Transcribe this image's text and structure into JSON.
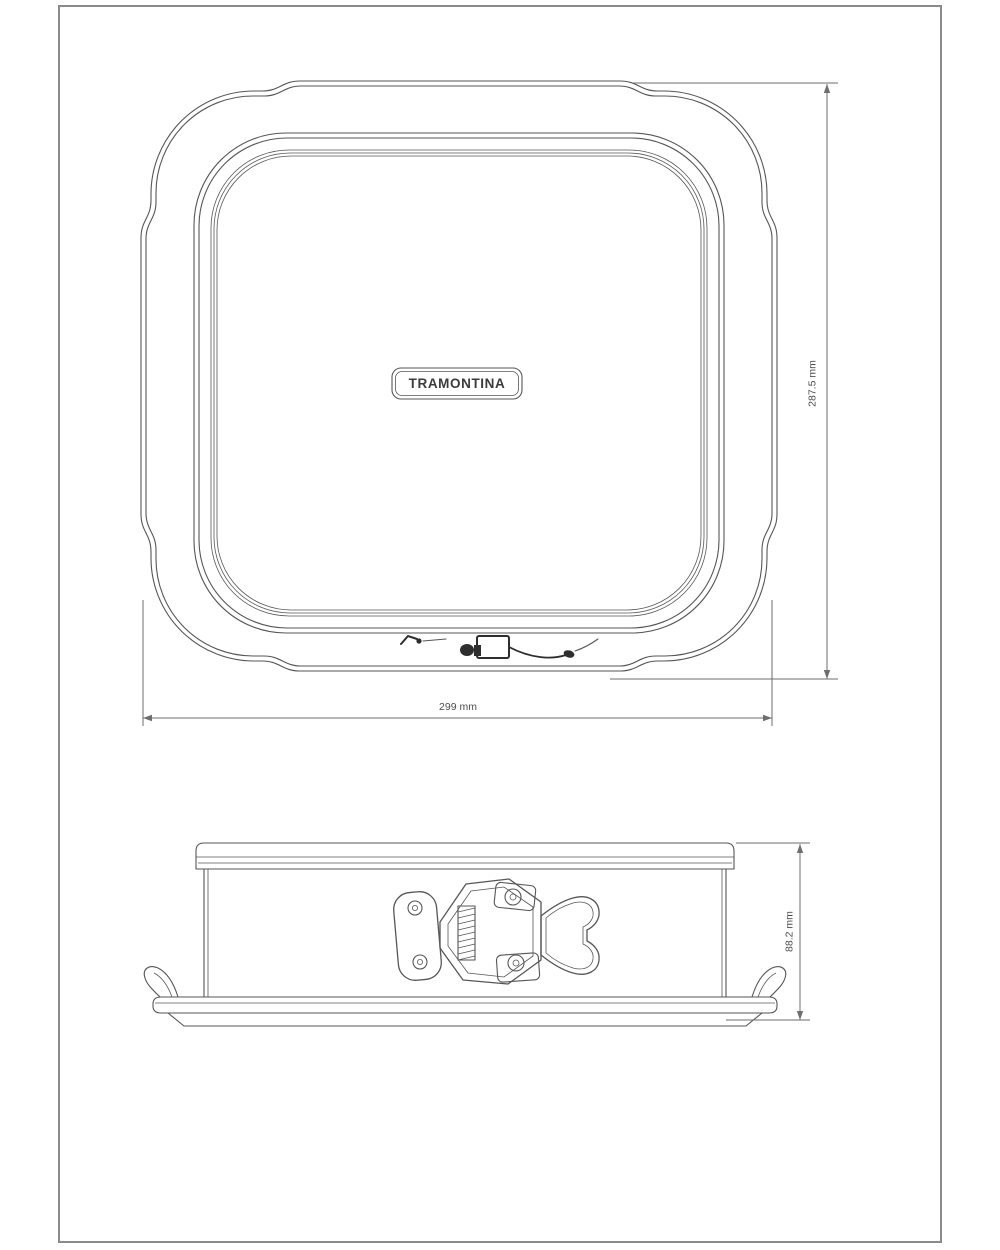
{
  "colors": {
    "background": "#ffffff",
    "line": "#565656",
    "dim": "#6e6e6e",
    "text": "#4d4d4d",
    "dark": "#2e2e2e",
    "frame": "#8a8a8a"
  },
  "views": {
    "top": {
      "brand_label": "TRAMONTINA",
      "width_dimension": "299 mm",
      "height_dimension": "287.5 mm"
    },
    "side": {
      "height_dimension": "88.2 mm"
    }
  }
}
